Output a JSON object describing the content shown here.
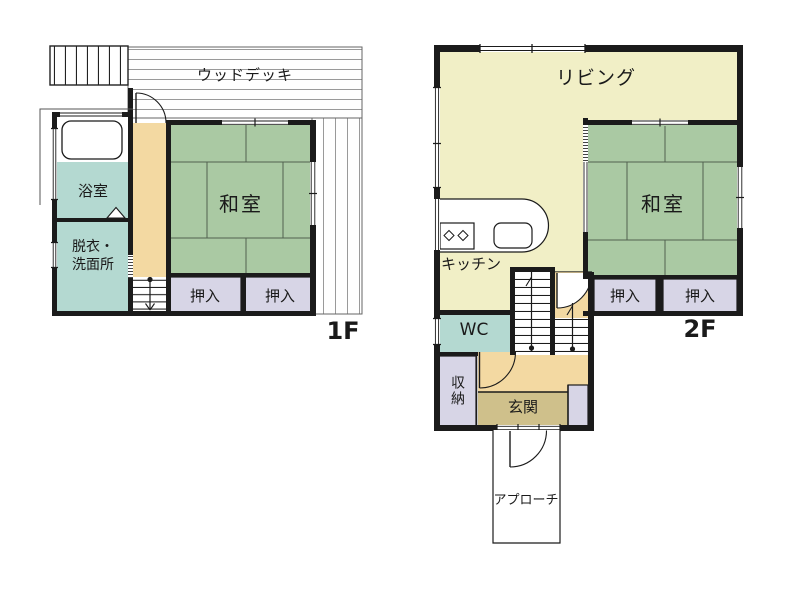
{
  "plan": {
    "floor1": {
      "label": "1F",
      "deck": "ウッドデッキ",
      "bath": "浴室",
      "washroom_line1": "脱衣・",
      "washroom_line2": "洗面所",
      "tatami_room": "和室",
      "closet_left": "押入",
      "closet_right": "押入"
    },
    "floor2": {
      "label": "2F",
      "living": "リビング",
      "kitchen": "キッチン",
      "tatami_room": "和室",
      "closet_left": "押入",
      "closet_right": "押入",
      "wc": "WC",
      "storage": "収納",
      "entrance": "玄関",
      "approach": "アプローチ"
    }
  },
  "colors": {
    "wall": "#1b1b1b",
    "tatami": "#aac9a3",
    "living": "#f1efc6",
    "hall": "#f3d9a2",
    "entrance": "#cfc08b",
    "wet": "#b4d9d1",
    "closet": "#d7d5e6",
    "deckline": "#9a9a9a"
  }
}
